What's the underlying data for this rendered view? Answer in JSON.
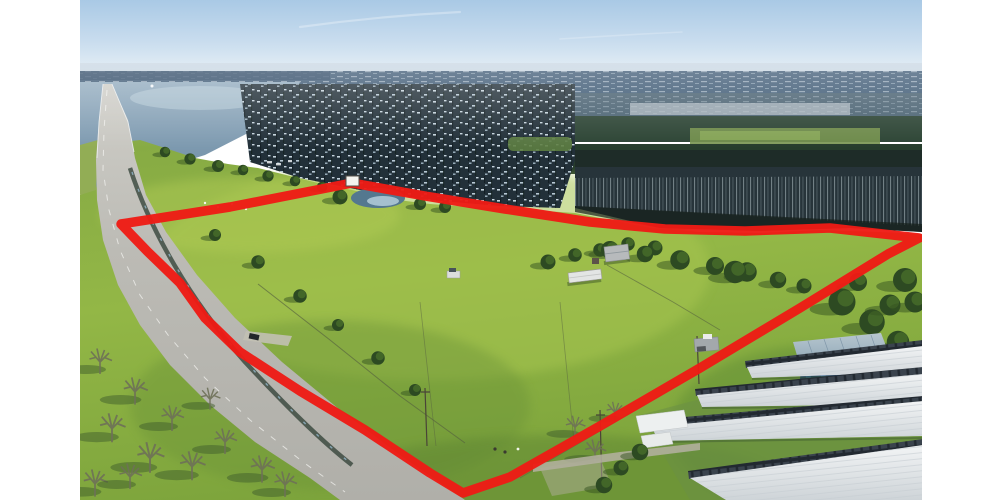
{
  "meta": {
    "type": "aerial-photograph",
    "subject": "Drone aerial photo of rural acreage outlined in red, beside a lake with a highway causeway, flooded timber, green pasture and a storage-unit facility",
    "canvas_width": 1000,
    "canvas_height": 500,
    "photo_left": 80,
    "photo_right": 922,
    "margin_color": "#ffffff"
  },
  "boundary": {
    "color": "#ee1b15",
    "stroke_width": 9.5,
    "marker_sign": {
      "x": 346,
      "y": 176,
      "width": 13,
      "height": 10,
      "fill": "#f3f3ef",
      "stroke": "#56524b"
    },
    "points": [
      [
        121,
        224
      ],
      [
        230,
        207
      ],
      [
        352,
        183
      ],
      [
        425,
        196
      ],
      [
        505,
        209
      ],
      [
        590,
        222
      ],
      [
        665,
        229
      ],
      [
        745,
        231
      ],
      [
        830,
        228
      ],
      [
        919,
        238
      ],
      [
        888,
        254
      ],
      [
        800,
        308
      ],
      [
        700,
        368
      ],
      [
        600,
        426
      ],
      [
        510,
        477
      ],
      [
        463,
        493
      ],
      [
        430,
        473
      ],
      [
        365,
        430
      ],
      [
        300,
        391
      ],
      [
        240,
        352
      ],
      [
        205,
        318
      ],
      [
        180,
        283
      ],
      [
        148,
        252
      ]
    ]
  },
  "palette": {
    "sky_top": "#a9c9e5",
    "sky_horizon": "#e7f0f6",
    "distant_water": "#3e5a75",
    "lake": "#7e9cb4",
    "flooded_timber": "#223039",
    "timber_glint": "#cfdde6",
    "pasture_base": "#8db13f",
    "pasture_bright": "#a6c44f",
    "pasture_shadow": "#6a9238",
    "road": "#bcbbb5",
    "boundary_red": "#ee1b15",
    "storage_roof": "#eef1f2",
    "storage_front": "#232a31",
    "blue_roof": "#8aa3b4",
    "blue_front": "#2d5b8c",
    "tree_dark": "#2d4a22",
    "bare_tree": "#6e7058"
  },
  "scene": {
    "features": [
      "sky",
      "contrails",
      "distant-shoreline",
      "lake",
      "highway-causeway",
      "flooded-timber",
      "pond",
      "shore-hill",
      "pasture",
      "creek",
      "fences",
      "farmstead",
      "bare-trees",
      "storage-facility",
      "blue-building",
      "carport",
      "property-boundary"
    ]
  }
}
